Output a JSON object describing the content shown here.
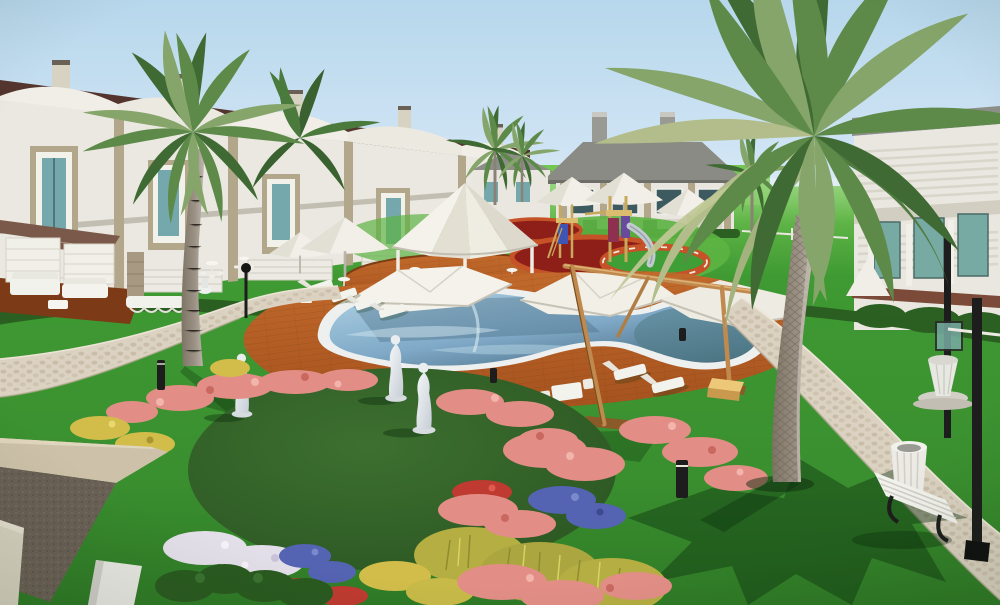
{
  "meta": {
    "kind": "3d-architectural-rendering",
    "subject": "Resort residential courtyard with kidney-shaped pool, shade sails, playground, palm trees, statues and flower gardens",
    "view": "elevated three-quarter overview",
    "width": 1000,
    "height": 605
  },
  "scene": {
    "objects": [
      "two-story white villas with curved parapets and maroon roofs",
      "large villa with gray hip roof and chimneys",
      "two large date palms and several distant palms",
      "kidney-shaped swimming pool with white coping",
      "white tensile shade sails on timber masts",
      "white canopy gazebo with bistro tables",
      "white patio umbrellas",
      "children's playground with slide on red rubber circles",
      "orange-brown timber pool deck",
      "curving cobblestone garden paths",
      "circular lawn mound with three classical white statues",
      "flower beds: pink, yellow, blue, white, red",
      "white garden bench and slatted litter bin",
      "black street lamps and bollard lights",
      "white outdoor sofa set under awning",
      "sun loungers",
      "foreground building roof corner"
    ],
    "statue_count": 3,
    "large_palm_count": 2,
    "shade_sail_count": 3
  },
  "palette": {
    "sky_top": "#b7d7ec",
    "sky_mid": "#cfe4f4",
    "sky_horizon": "#e8f3fa",
    "lawn": "#3f9a33",
    "lawn_bright": "#5cb443",
    "lawn_distant": "#74c653",
    "lawn_shadow": "#1e4c18",
    "mound_green": "#3d7030",
    "mound_edge": "#2b5622",
    "hedge_green": "#2b5f21",
    "path_light": "#dbd2c1",
    "path_stone": "#c7bba6",
    "deck_wood": "#a5521e",
    "deck_wood_light": "#c26a2c",
    "deck_wood_dark": "#7c3d14",
    "pool_coping": "#edf0ee",
    "pool_water": "#7fa9c7",
    "pool_water_light": "#aed2e4",
    "pool_water_dark": "#46687e",
    "pool_teal": "#527e88",
    "canopy_white": "#f4f2ea",
    "canopy_shade": "#ddd9cd",
    "umbrella_white": "#f1efe7",
    "mast_wood": "#c08a4e",
    "mast_wood_dark": "#7c4e1e",
    "roof_maroon": "#54352e",
    "roof_gray": "#8b8b85",
    "wall_white": "#eae8e0",
    "wall_shade": "#d3d0c7",
    "wall_trim": "#b2a68b",
    "window_teal": "#74a8ac",
    "glass_teal": "#78aaa4",
    "rubber_red": "#8d1e18",
    "ring_orange": "#c55327",
    "play_wood": "#dcbc6e",
    "panel_blue": "#4054b2",
    "panel_magenta": "#8e3050",
    "panel_purple": "#6a4a9c",
    "slide_metal": "#c2cad1",
    "flower_pink": "#e28e86",
    "flower_pink_light": "#f2b4ab",
    "flower_pink_deep": "#c9685f",
    "flower_yellow": "#d2bd4a",
    "flower_blue": "#5463b2",
    "flower_white": "#e3dfe9",
    "flower_red": "#bf3a31",
    "grass_olive": "#b5ae42",
    "palm_trunk": "#9a9184",
    "palm_dark": "#3f6a33",
    "palm_mid": "#5d8a49",
    "palm_light": "#85a56a",
    "palm_pale": "#b2bd8b",
    "statue_white": "#eaeef1",
    "bench_white": "#f2f2ed",
    "metal_black": "#1d1d1d",
    "fascia_taupe": "#6a6055",
    "parapet_beige": "#cdc2a9",
    "roof_dark": "#34342f",
    "pillar_white": "#e9e8e3",
    "crate_yellow": "#ecc878"
  }
}
